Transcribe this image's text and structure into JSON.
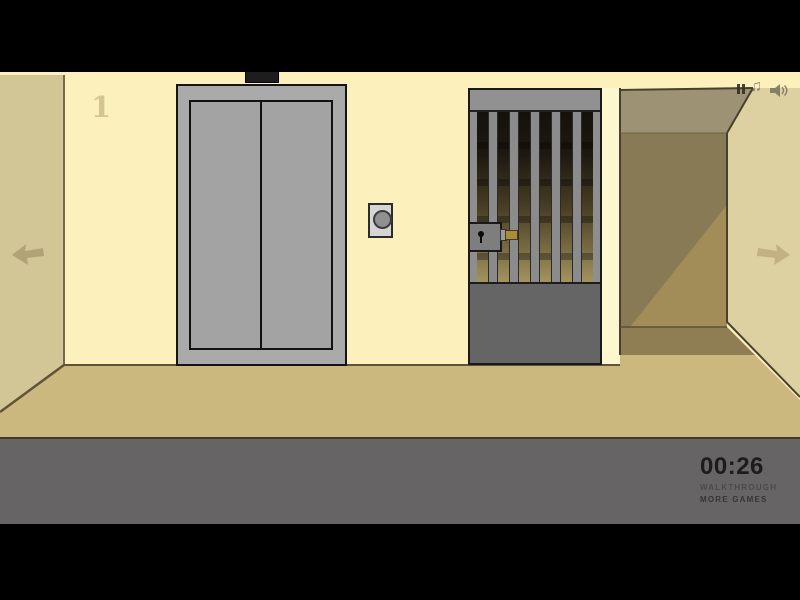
{
  "game": {
    "floor_indicator": "1",
    "room": {
      "elevator": "elevator with closed doors",
      "call_button": "elevator call button",
      "gate": "barred prison gate",
      "lock": "gate lock with keyhole",
      "corridor": "dark corridor to the right"
    },
    "nav": {
      "left_arrow": "navigate-left",
      "right_arrow": "navigate-right"
    }
  },
  "hud": {
    "timer": "00:26",
    "walkthrough_label": "WALKTHROUGH",
    "more_games_label": "MORE GAMES",
    "music_note_glyph": "♫",
    "icons": [
      "pause-icon",
      "music-icon",
      "sound-icon"
    ]
  },
  "palette": {
    "wall_cream": "#fcf1bd",
    "wall_left_tan": "#d2c596",
    "wall_right_tan": "#ded1a1",
    "floor_tan": "#cbb87e",
    "corridor_ceiling": "#9d9374",
    "corridor_back_wall": "#897a56",
    "corridor_light_wedge": "#a28d58",
    "elevator_gray": "#aaaaaa",
    "gate_gray": "#8e8e8e",
    "hud_bar_gray": "#666464",
    "hud_text_dark": "#1c1c1c"
  }
}
